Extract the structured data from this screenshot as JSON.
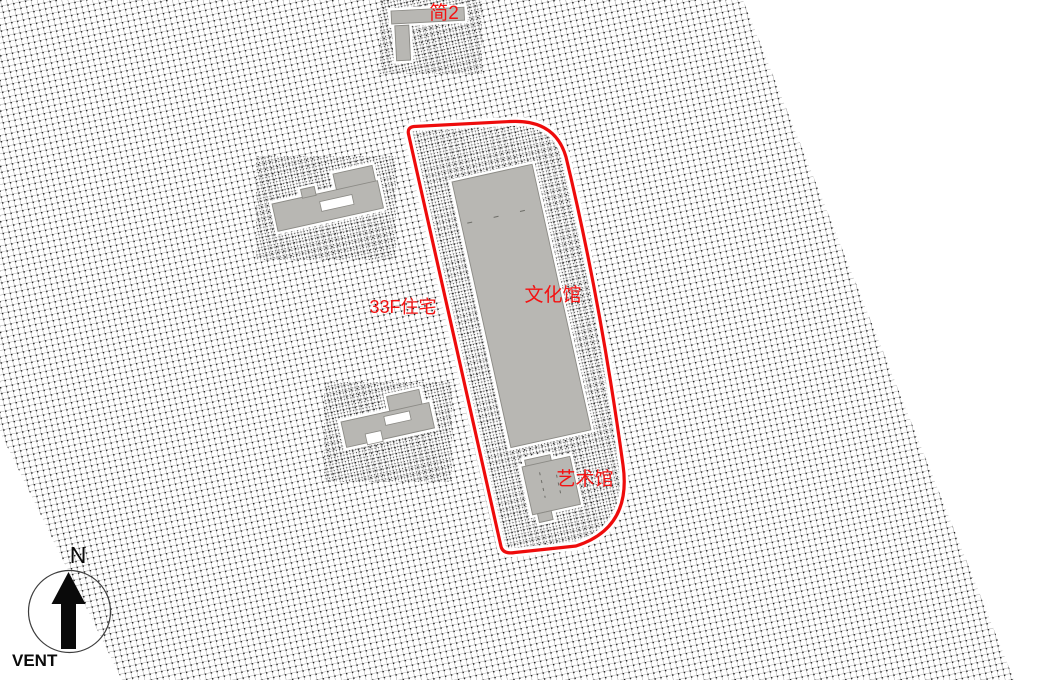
{
  "canvas": {
    "labels": {
      "top_building": "简2",
      "residential": "33F住宅",
      "culture_hall": "文化馆",
      "art_hall": "艺术馆"
    },
    "compass": {
      "north": "N",
      "vent": "VENT"
    },
    "colors": {
      "background": "#ffffff",
      "label_red": "#f41212",
      "boundary_red": "#ee0c0c",
      "building_fill": "#b8b7b3",
      "building_stroke": "#8b8a85",
      "halo_white": "#ffffff",
      "mesh_line": "#8f8f8f",
      "mesh_node": "#161616",
      "compass_black": "#0a0a0a"
    }
  }
}
